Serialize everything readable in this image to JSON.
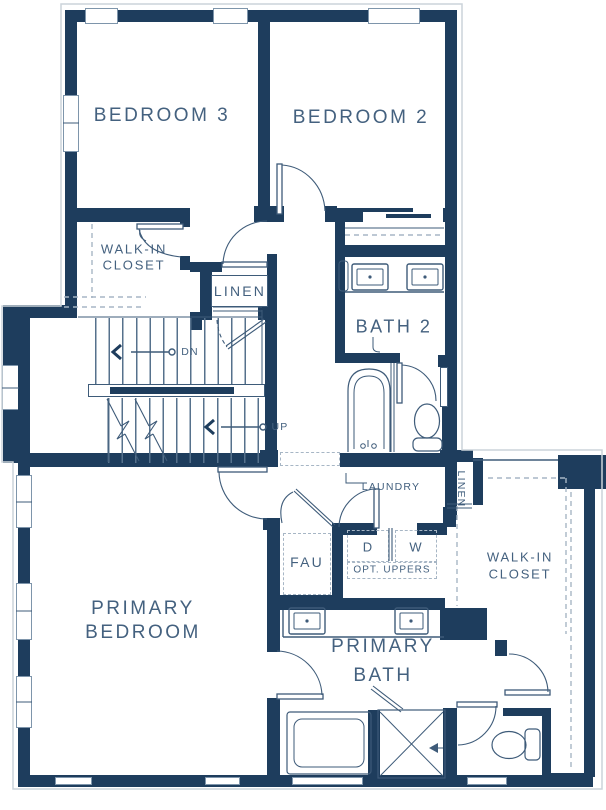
{
  "colors": {
    "wall": "#1e3d5d",
    "line": "#3e5b79",
    "text": "#44617f",
    "dashed_shelving": "#a7b6c5",
    "exterior_outline": "#ccd3da",
    "background": "#ffffff"
  },
  "rooms": {
    "bedroom3": "BEDROOM 3",
    "bedroom2": "BEDROOM 2",
    "walk_in_closet_left": [
      "WALK-IN",
      "CLOSET"
    ],
    "linen_upper": "LINEN",
    "bath2": "BATH 2",
    "laundry": "LAUNDRY",
    "fau": "FAU",
    "dryer": "D",
    "washer": "W",
    "opt_uppers": "OPT. UPPERS",
    "linen_lower": "LINEN",
    "walk_in_closet_right": [
      "WALK-IN",
      "CLOSET"
    ],
    "primary_bedroom": [
      "PRIMARY",
      "BEDROOM"
    ],
    "primary_bath": [
      "PRIMARY",
      "BATH"
    ]
  },
  "stairs": {
    "down_label": "DN",
    "up_label": "UP"
  }
}
